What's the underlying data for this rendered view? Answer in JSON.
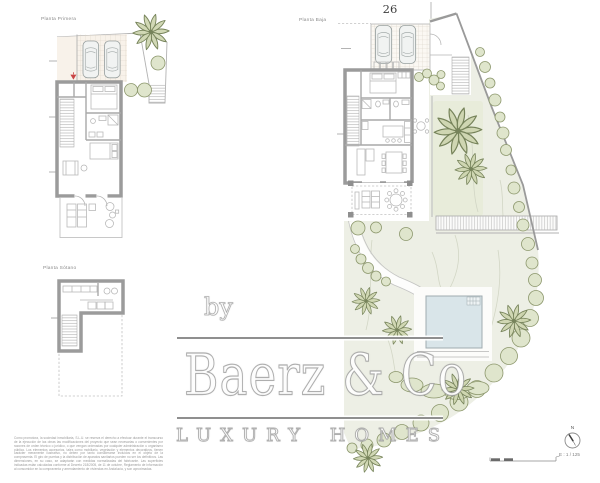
{
  "page": {
    "plan_number": "26",
    "scale_label": "E : 1 / 125",
    "compass_north": "N"
  },
  "plan_labels": {
    "first_floor": "Planta Primera",
    "ground_floor": "Planta Baja",
    "basement": "Planta Sótano"
  },
  "watermark": {
    "prefix": "by",
    "brand": "Baerz & Co",
    "tagline": "LUXURY HOMES"
  },
  "disclaimer": "Como promotora, la sociedad inmobiliaria, S.L.U. se reserva el derecho a efectuar durante el transcurso de la ejecución de las obras las modificaciones del proyecto que sean necesarias o convenientes por razones de orden técnico o jurídico, o que vengan ordenadas por cualquier administración u organismo público. Los elementos accesorios, tales como mobiliario, vegetación y elementos decorativos, tienen carácter meramente ilustrativo, no deben por tanto considerarse incluidos en el objeto de la compraventa. El giro de puertas y la distribución de aparatos sanitarios pueden no ser los definitivos. Las dimensiones, en su caso, se adaptarán con medidas normalizadas del fabricante. Las superficies indicadas están calculadas conforme al Decreto 218/2005, de 11 de octubre, Reglamento de Información al consumidor en la compraventa y arrendamiento de viviendas en Andalucía, y son aproximadas.",
  "colors": {
    "wall": "#9b9b9b",
    "garden": "#edefe5",
    "lawn": "#e8ecda",
    "pool": "#d9e5e9",
    "vegetation_fill": "#dfe5cc",
    "vegetation_stroke": "#8c976c",
    "garage_floor": "#f8f2ea",
    "entry_marker": "#c94545",
    "watermark_grey": "#8f8f8f"
  }
}
